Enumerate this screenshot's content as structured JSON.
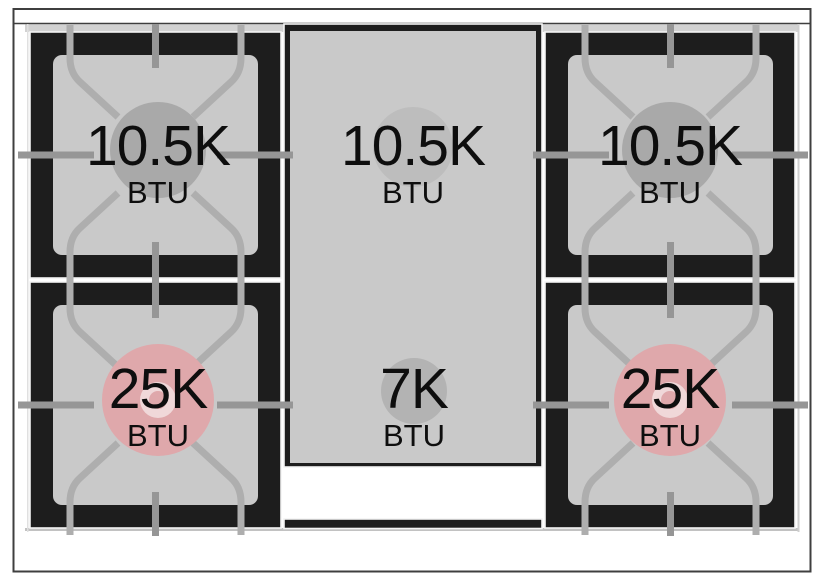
{
  "diagram": {
    "kind": "range-cooktop-burner-ratings",
    "unit_label": "BTU"
  },
  "colors": {
    "cooktop_black": "#1d1d1d",
    "surface_gray": "#c9c9c9",
    "rim_gray": "#d2d2d2",
    "seam_white": "#f4f4f4",
    "grate_light": "#aeaeae",
    "grate_dark": "#969696",
    "frame_dark": "#3f3f3f",
    "burner_circle_gray": "#a9a9a9",
    "griddle_circle_gray": "#bdbdbd",
    "simmer_circle_gray": "#b3b3b3",
    "power_circle_pink": "#dfa8ab",
    "power_ring_pink": "#f0d8d9",
    "label_black": "#0e0e0e"
  },
  "cooktop": {
    "burners": [
      {
        "name": "left-rear",
        "value": "10.5K",
        "unit": "BTU"
      },
      {
        "name": "center-griddle-rear",
        "value": "10.5K",
        "unit": "BTU"
      },
      {
        "name": "right-rear",
        "value": "10.5K",
        "unit": "BTU"
      },
      {
        "name": "left-front",
        "value": "25K",
        "unit": "BTU"
      },
      {
        "name": "center-griddle-front",
        "value": "7K",
        "unit": "BTU"
      },
      {
        "name": "right-front",
        "value": "25K",
        "unit": "BTU"
      }
    ]
  }
}
